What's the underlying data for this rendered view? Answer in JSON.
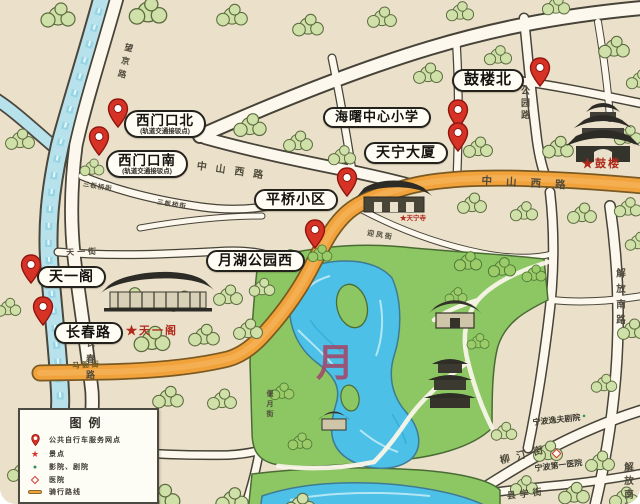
{
  "stations": [
    {
      "label": "西门口北",
      "sublabel": "(轨道交通接驳点)"
    },
    {
      "label": "西门口南",
      "sublabel": "(轨道交通接驳点)"
    },
    {
      "label": "鼓楼北"
    },
    {
      "label": "海曙中心小学"
    },
    {
      "label": "天宁大厦"
    },
    {
      "label": "平桥小区"
    },
    {
      "label": "月湖公园西"
    },
    {
      "label": "天一阁"
    },
    {
      "label": "长春路"
    }
  ],
  "streets": [
    {
      "text": "中山西路"
    },
    {
      "text": "中山西路"
    },
    {
      "text": "公园路"
    },
    {
      "text": "解放南路"
    },
    {
      "text": "解放南路"
    },
    {
      "text": "柳汀街"
    },
    {
      "text": "县学街"
    },
    {
      "text": "马衙街"
    },
    {
      "text": "长春路"
    },
    {
      "text": "望京路"
    },
    {
      "text": "天一街"
    },
    {
      "text": "三板桥街"
    },
    {
      "text": "三板桥街"
    },
    {
      "text": "迎凤街"
    },
    {
      "text": "偃月街"
    }
  ],
  "pois": [
    {
      "text": "★鼓楼"
    },
    {
      "text": "★天一阁"
    },
    {
      "text": "★天宁寺"
    },
    {
      "text": "宁波逸夫剧院"
    },
    {
      "text": "宁波第一医院"
    }
  ],
  "lake_label": "月",
  "legend": {
    "title": "图例",
    "items": [
      {
        "label": "公共自行车服务网点"
      },
      {
        "label": "景点"
      },
      {
        "label": "影院、剧院"
      },
      {
        "label": "医院"
      },
      {
        "label": "骑行路线"
      }
    ]
  },
  "colors": {
    "route": "#f1a23a",
    "pin": "#d63226",
    "river": "#b7e2ec",
    "lake": "#4cc0e6",
    "park": "#8cc763",
    "scenic_star": "#b0291b"
  }
}
